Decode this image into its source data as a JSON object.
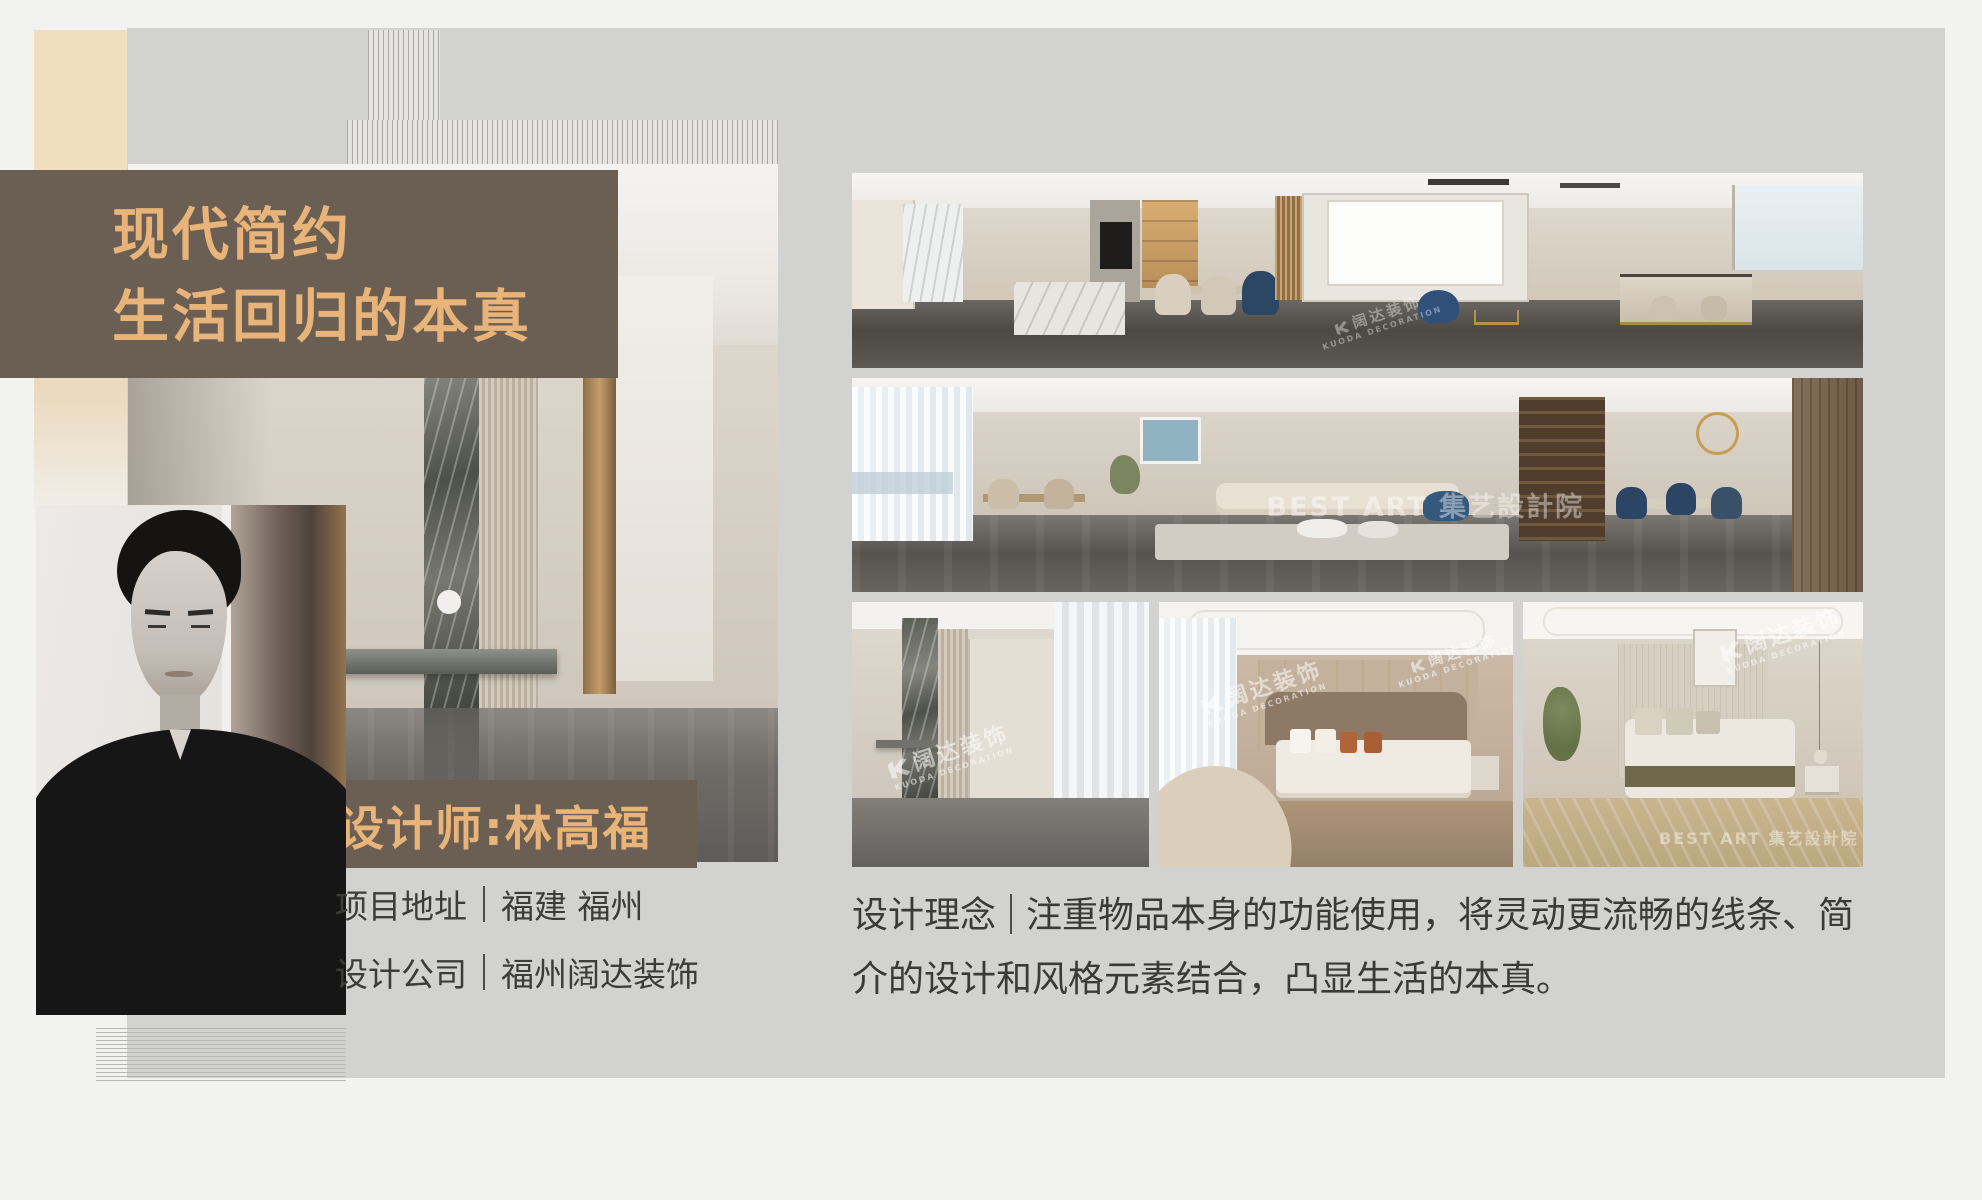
{
  "poster": {
    "title": {
      "line1": "现代简约",
      "line2": "生活回归的本真"
    },
    "designer": {
      "label": "设计师:林高福"
    },
    "project": {
      "address_label": "项目地址",
      "address_value": "福建 福州",
      "company_label": "设计公司",
      "company_value": "福州阔达装饰"
    },
    "concept": {
      "label": "设计理念",
      "text": "注重物品本身的功能使用，将灵动更流畅的线条、简介的设计和风格元素结合，凸显生活的本真。"
    },
    "watermark": {
      "cn": "阔达装饰",
      "en": "KUODA DECORATION",
      "studio": "BEST ART 集艺設計院"
    },
    "colors": {
      "banner_brown": "#6b5f53",
      "accent_orange": "#e9b479",
      "cream": "#f0debf",
      "panel_gray": "#d2d2d1",
      "text_dark": "#3a3a39",
      "accent_navy": "#2f4e79"
    },
    "photos": [
      {
        "id": "corridor-large",
        "desc": "hallway with marble inlay column"
      },
      {
        "id": "kitchen-dining-panorama",
        "desc": "open kitchen, dining table and tv wall"
      },
      {
        "id": "living-room-panorama",
        "desc": "living room with sofa, cabinet and round dining table"
      },
      {
        "id": "hallway-small",
        "desc": "corridor with marble strip and window"
      },
      {
        "id": "bedroom-curved-sofa",
        "desc": "bedroom with curved sofa and upholstered bed"
      },
      {
        "id": "bedroom-wood-floor",
        "desc": "bedroom with bed, plant and pendant lamp"
      }
    ]
  }
}
